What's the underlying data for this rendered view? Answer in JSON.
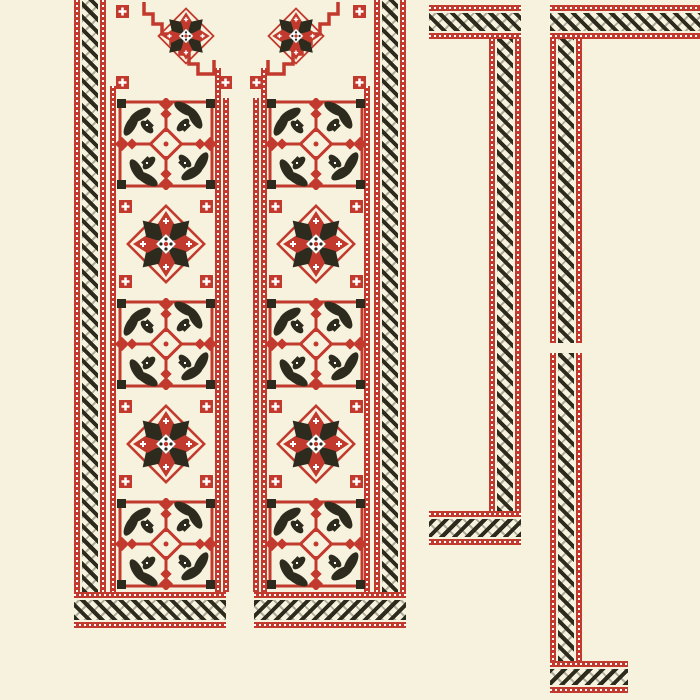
{
  "title": "Cross-stitch embroidery pattern sheet (vyshyvanka shirt front and two border strips) in red and black on cream",
  "colors": {
    "background": "#f6f2de",
    "red": "#c23a2d",
    "black": "#2d2b1e",
    "dot": "#ffffff"
  },
  "band_style": {
    "edges": "red line with white dots",
    "core": "black vine meander"
  },
  "pieces": {
    "front": {
      "panels": [
        {
          "id": "left",
          "corner_motif": "corner-star",
          "motif_rows": [
            "floral",
            "star",
            "floral",
            "star",
            "floral"
          ]
        },
        {
          "id": "right",
          "corner_motif": "corner-star-mirrored",
          "motif_rows": [
            "floral",
            "star",
            "floral",
            "star",
            "floral"
          ]
        }
      ],
      "borders": [
        "left-vertical-band",
        "right-vertical-band",
        "bottom-left-band",
        "bottom-right-band",
        "placket-dotted-lines"
      ]
    },
    "strip_middle": {
      "shape": "bracket-open-left",
      "bars": [
        "top",
        "right",
        "bottom"
      ]
    },
    "strip_right_edge": {
      "shape": "bracket-open-right",
      "bars": [
        "top",
        "left-upper",
        "left-lower",
        "bottom"
      ],
      "gap_in_left_bar_y": [
        343,
        353
      ]
    }
  },
  "motif_legend": [
    {
      "type": "floral",
      "description": "red framed square, black corner squares, four black leaf clusters, red diamond cross center"
    },
    {
      "type": "star",
      "description": "eight-point star with alternating red and black points, red diamond outline, red corner cross badges"
    },
    {
      "type": "corner-star",
      "description": "neckline corner: stepped red line, half star, red cross badges"
    }
  ]
}
